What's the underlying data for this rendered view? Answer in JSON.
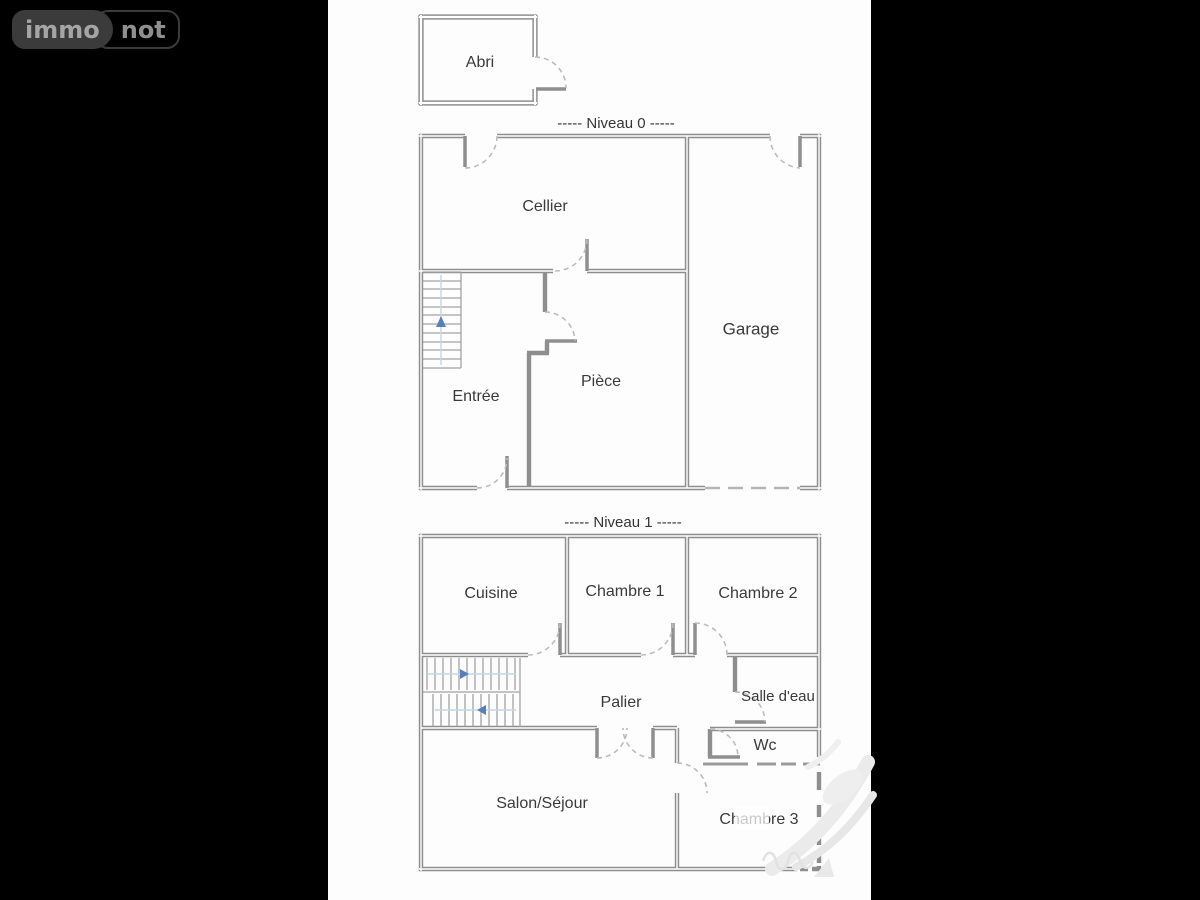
{
  "logo": {
    "immo": "immo",
    "not": "not"
  },
  "levels": {
    "level0": {
      "title": "-----  Niveau 0  -----",
      "outbuilding": "Abri",
      "rooms": {
        "cellier": "Cellier",
        "garage": "Garage",
        "entree": "Entrée",
        "piece": "Pièce"
      }
    },
    "level1": {
      "title": "-----  Niveau 1  -----",
      "rooms": {
        "cuisine": "Cuisine",
        "chambre1": "Chambre 1",
        "chambre2": "Chambre 2",
        "palier": "Palier",
        "salle_eau": "Salle d'eau",
        "wc": "Wc",
        "salon": "Salon/Séjour",
        "chambre3": "Chambre 3"
      }
    }
  },
  "colors": {
    "background": "#000000",
    "page": "#fdfdfd",
    "wall": "#8e8e8e",
    "door_leaf": "#8f8f8f",
    "door_arc": "#bcbcbc",
    "stair_line": "#a2a2a2",
    "direction_arrow": "#5580bd",
    "direction_line": "#c3d5ea",
    "label_text": "#3a3a3a",
    "watermark": "#ebebeb",
    "logo_pill": "#3b3b3b",
    "logo_text": "#a5a5a5"
  }
}
